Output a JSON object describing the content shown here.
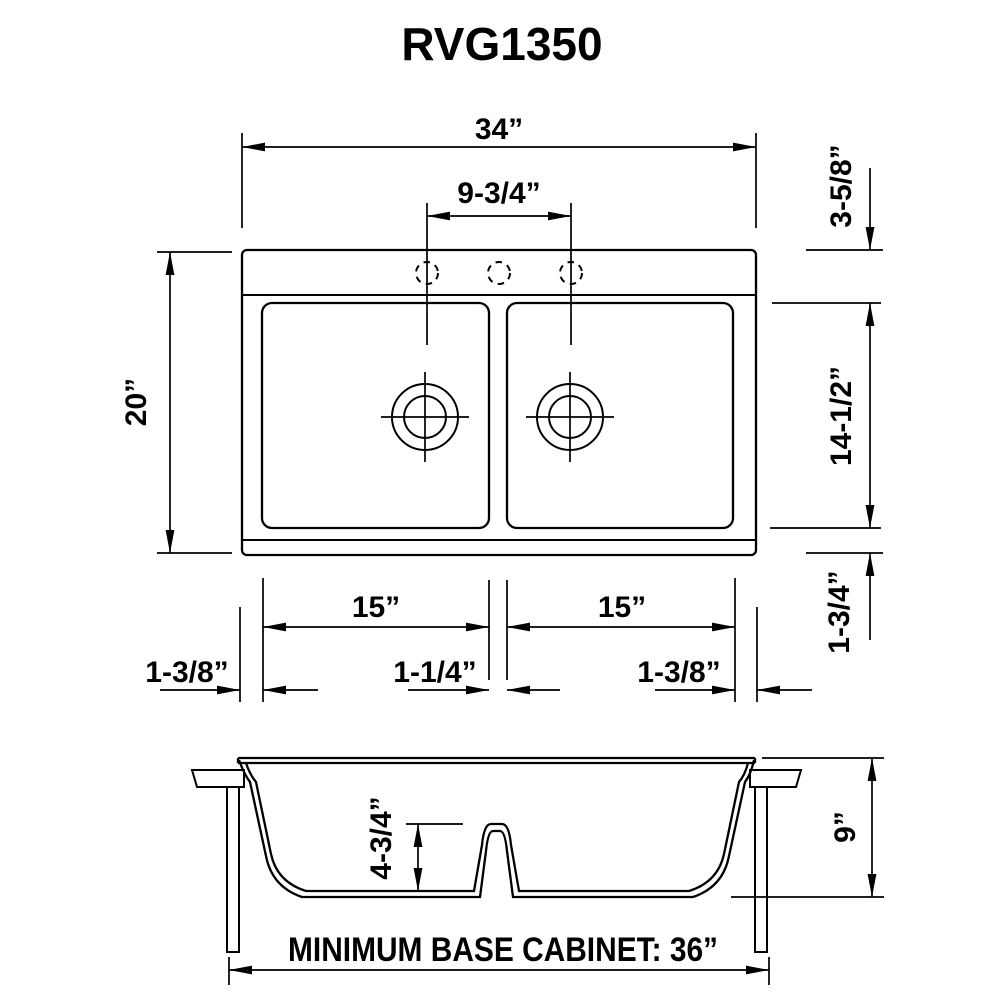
{
  "title": "RVG1350",
  "colors": {
    "line": "#000000",
    "background": "#ffffff"
  },
  "top_view": {
    "overall_width": "34”",
    "faucet_hole_spacing": "9-3/4”",
    "overall_front_to_back": "20”",
    "rim_to_bowl_top": "3-5/8”",
    "bowl_front_to_back": "14-1/2”",
    "bowl_to_bottom_edge": "1-3/4”",
    "left_bowl_width": "15”",
    "right_bowl_width": "15”",
    "left_rim_width": "1-3/8”",
    "center_divider_width": "1-1/4”",
    "right_rim_width": "1-3/8”",
    "faucet_hole_count": 3,
    "bowl_count": 2
  },
  "side_view": {
    "divider_height": "4-3/4”",
    "sink_depth": "9”",
    "cabinet_note": "MINIMUM BASE CABINET: 36”"
  }
}
